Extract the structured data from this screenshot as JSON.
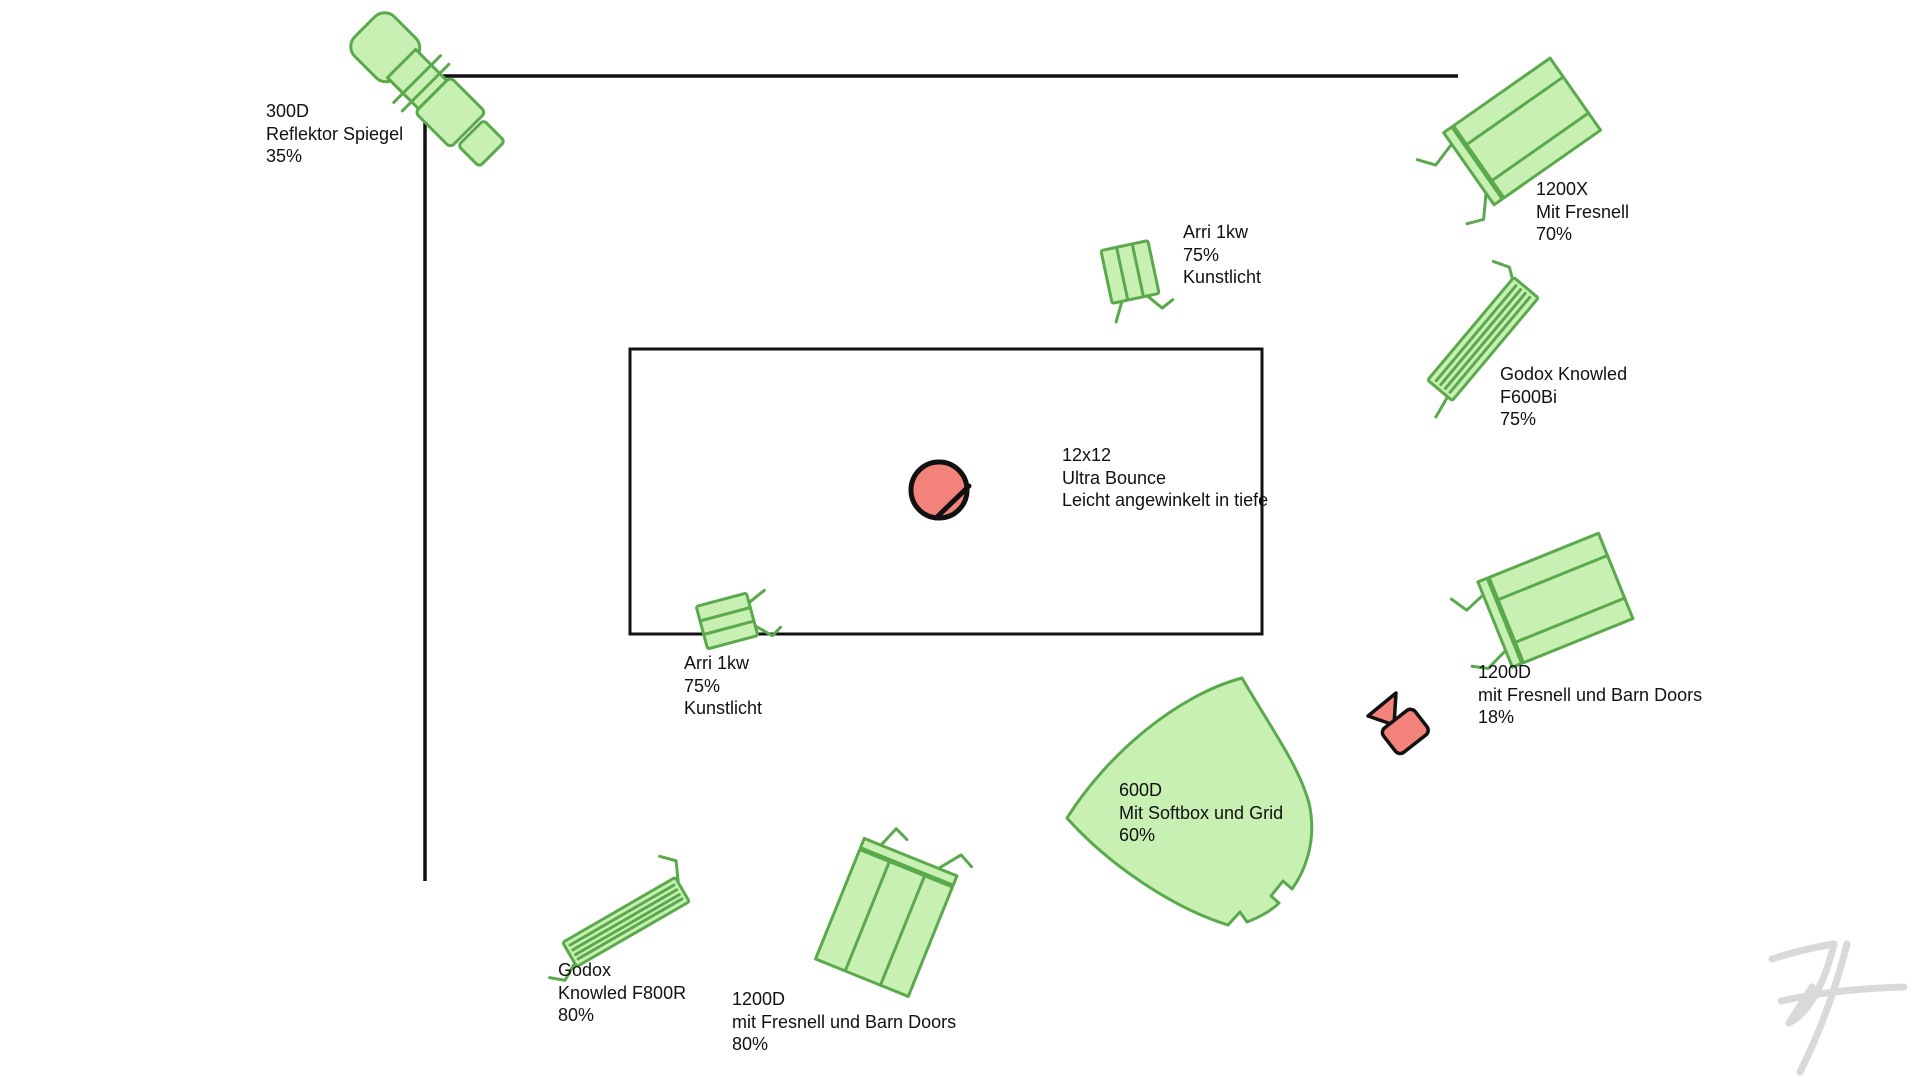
{
  "colors": {
    "light_fill": "#c8f0b2",
    "light_stroke": "#5aa94c",
    "accent_fill": "#f3837a",
    "outline": "#111111",
    "watermark": "#d9d9d9"
  },
  "labels": {
    "light_300d": "300D\nReflektor Spiegel\n35%",
    "light_1200x": "1200X\nMit Fresnell\n70%",
    "arri_top": "Arri 1kw\n75%\nKunstlicht",
    "godox_f600bi": "Godox Knowled\nF600Bi\n75%",
    "bounce": "12x12\nUltra Bounce\nLeicht angewinkelt in tiefe",
    "arri_floor": "Arri 1kw\n75%\nKunstlicht",
    "light_1200d_right": "1200D\nmit Fresnell und Barn Doors\n18%",
    "light_600d": "600D\nMit Softbox und Grid\n60%",
    "godox_f800r": "Godox\nKnowled F800R\n80%",
    "light_1200d_bottom": "1200D\nmit Fresnell und Barn Doors\n80%"
  }
}
